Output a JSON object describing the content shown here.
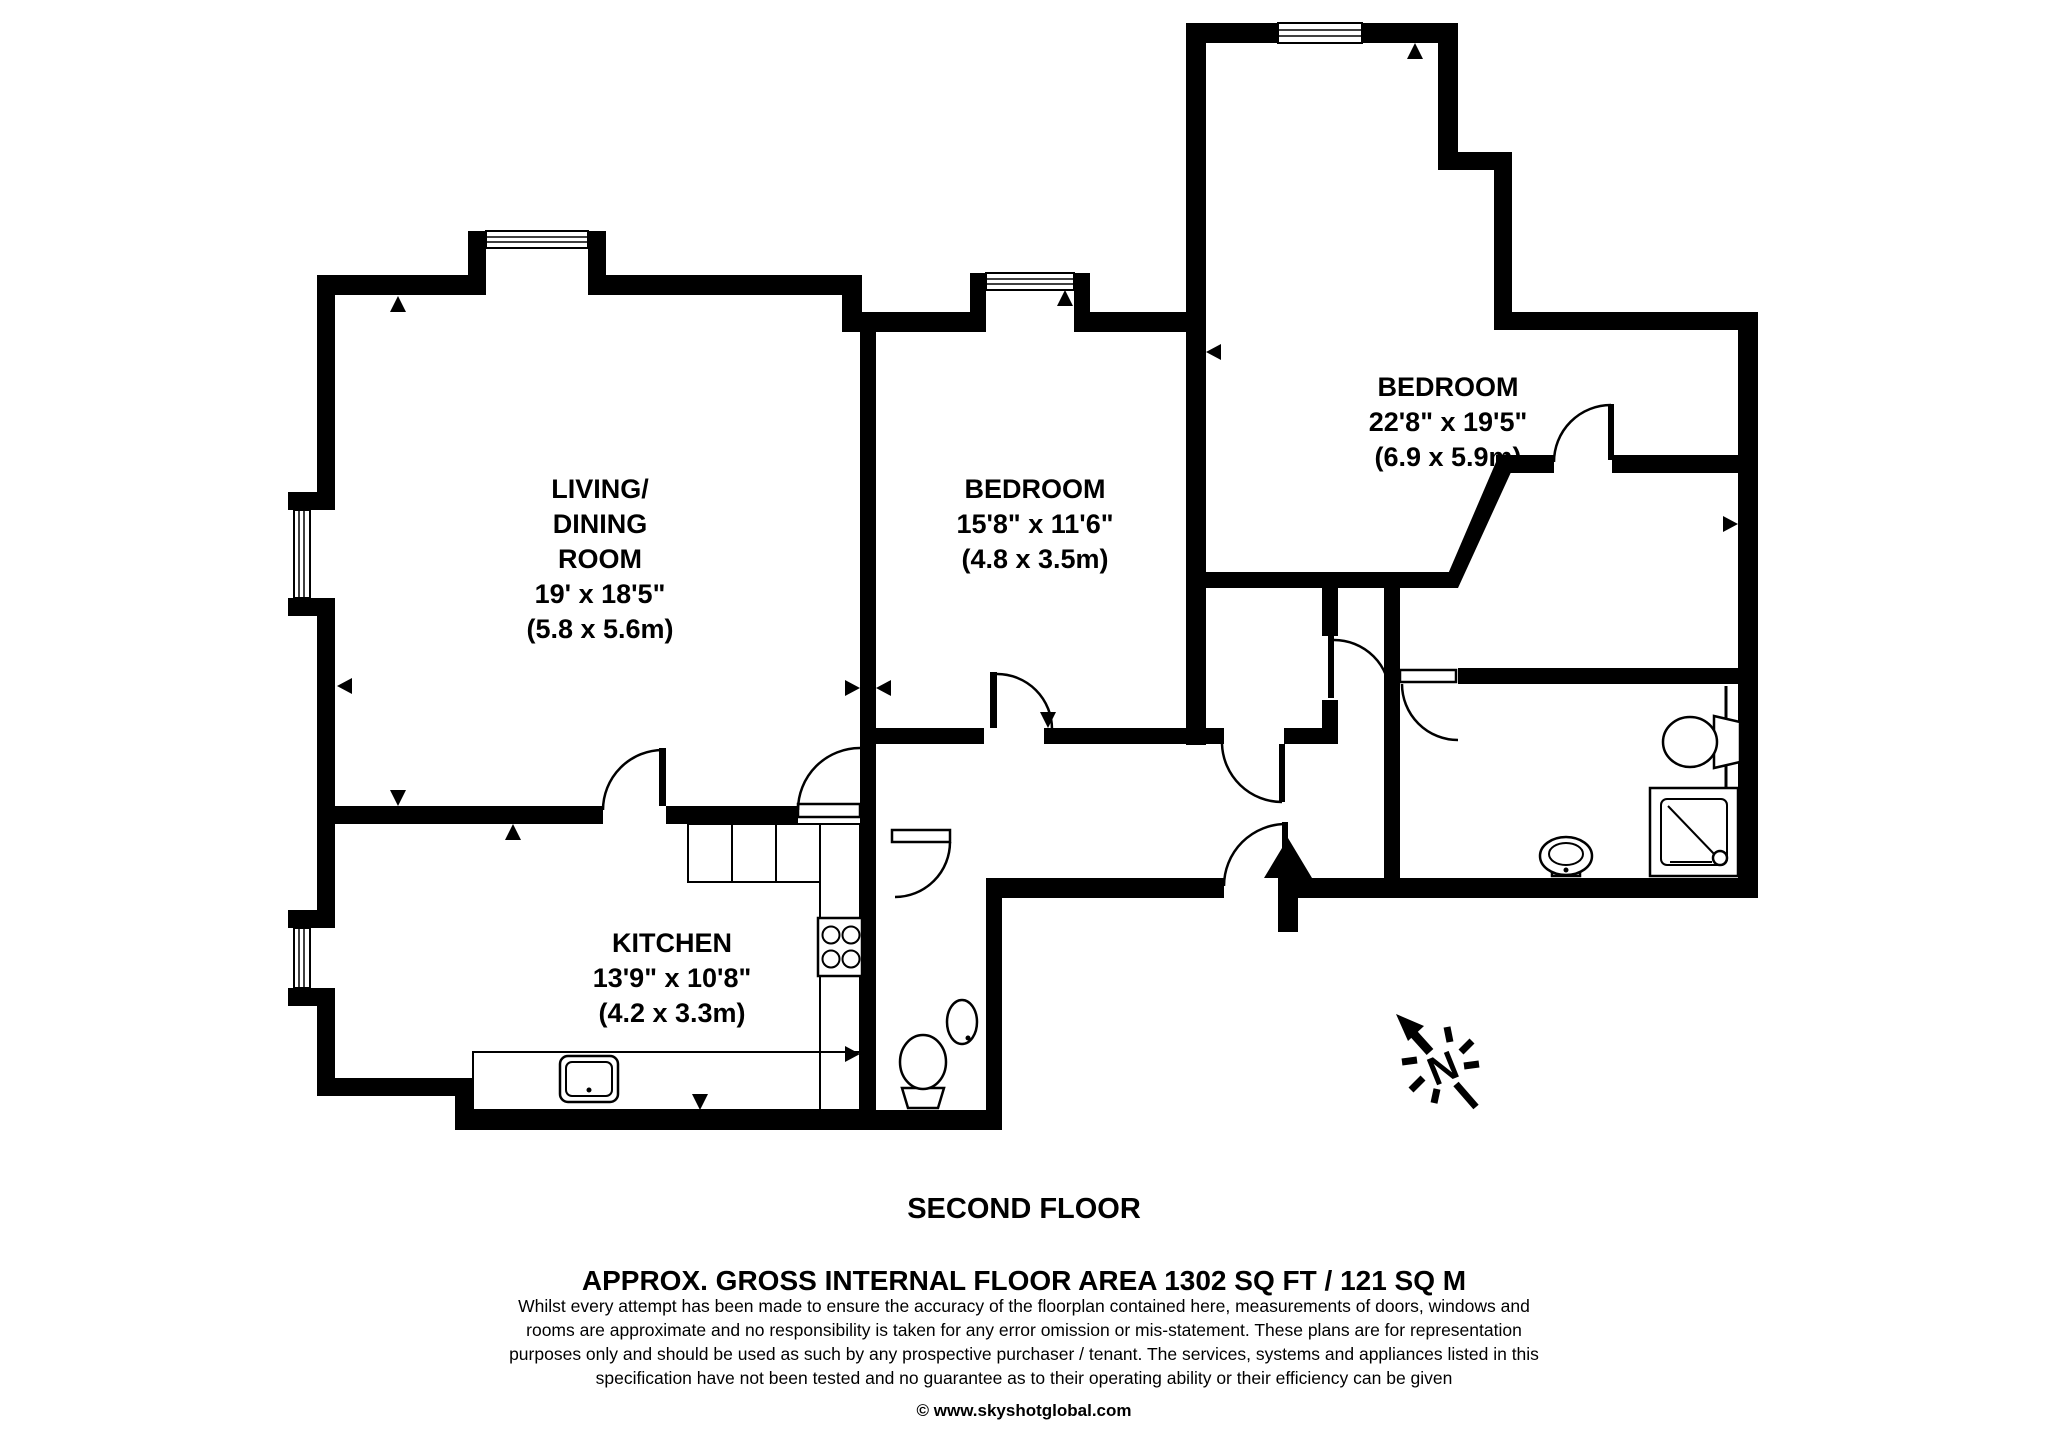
{
  "floorplan": {
    "floor_label": "SECOND FLOOR",
    "area_label": "APPROX. GROSS INTERNAL FLOOR AREA 1302 SQ FT / 121 SQ M",
    "disclaimer_lines": [
      "Whilst every attempt has been made to ensure the accuracy of the floorplan contained here, measurements of doors, windows and",
      "rooms are approximate and no responsibility is taken for any error omission or mis-statement. These plans are for representation",
      "purposes only and should  be used as such by any prospective purchaser / tenant. The services, systems and appliances listed in this",
      "specification have not been tested and no guarantee as to their operating ability or their efficiency can be given",
      "© www.skyshotglobal.com"
    ],
    "north_label": "N",
    "rooms": {
      "living": {
        "lines": [
          "LIVING/",
          "DINING",
          "ROOM"
        ],
        "imperial": "19' x 18'5\"",
        "metric": "(5.8 x 5.6m)"
      },
      "bedroom1": {
        "name": "BEDROOM",
        "imperial": "15'8\" x 11'6\"",
        "metric": "(4.8 x 3.5m)"
      },
      "bedroom2": {
        "name": "BEDROOM",
        "imperial": "22'8\" x 19'5\"",
        "metric": "(6.9 x 5.9m)"
      },
      "kitchen": {
        "name": "KITCHEN",
        "imperial": "13'9\" x 10'8\"",
        "metric": "(4.2 x 3.3m)"
      }
    }
  }
}
